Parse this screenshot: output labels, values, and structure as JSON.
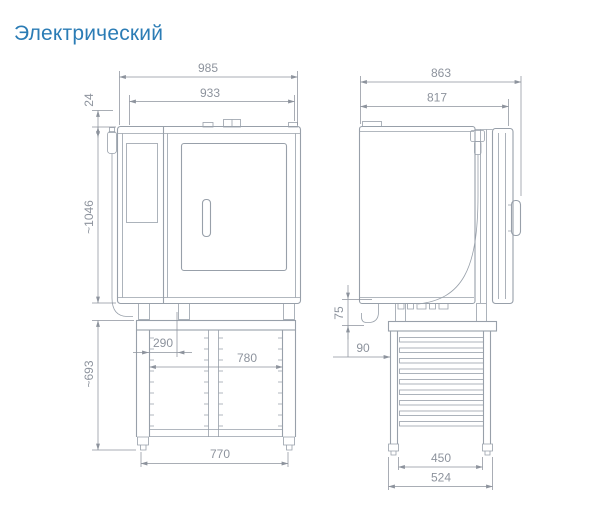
{
  "title": "Электрический",
  "colors": {
    "accent": "#2b7cb5",
    "line": "#98a0aa",
    "dim": "#8d939d"
  },
  "front_view": {
    "dim_overall_width": "985",
    "dim_body_width": "933",
    "dim_top_detail": "24",
    "dim_overall_height": "~1046",
    "dim_stand_height": "~693",
    "dim_foot_offset": "290",
    "dim_stand_clear_width": "780",
    "dim_stand_feet_width": "770"
  },
  "side_view": {
    "dim_overall_depth": "863",
    "dim_body_depth": "817",
    "dim_drain_height": "75",
    "dim_stand_setback": "90",
    "dim_feet_inner": "450",
    "dim_feet_outer": "524"
  }
}
